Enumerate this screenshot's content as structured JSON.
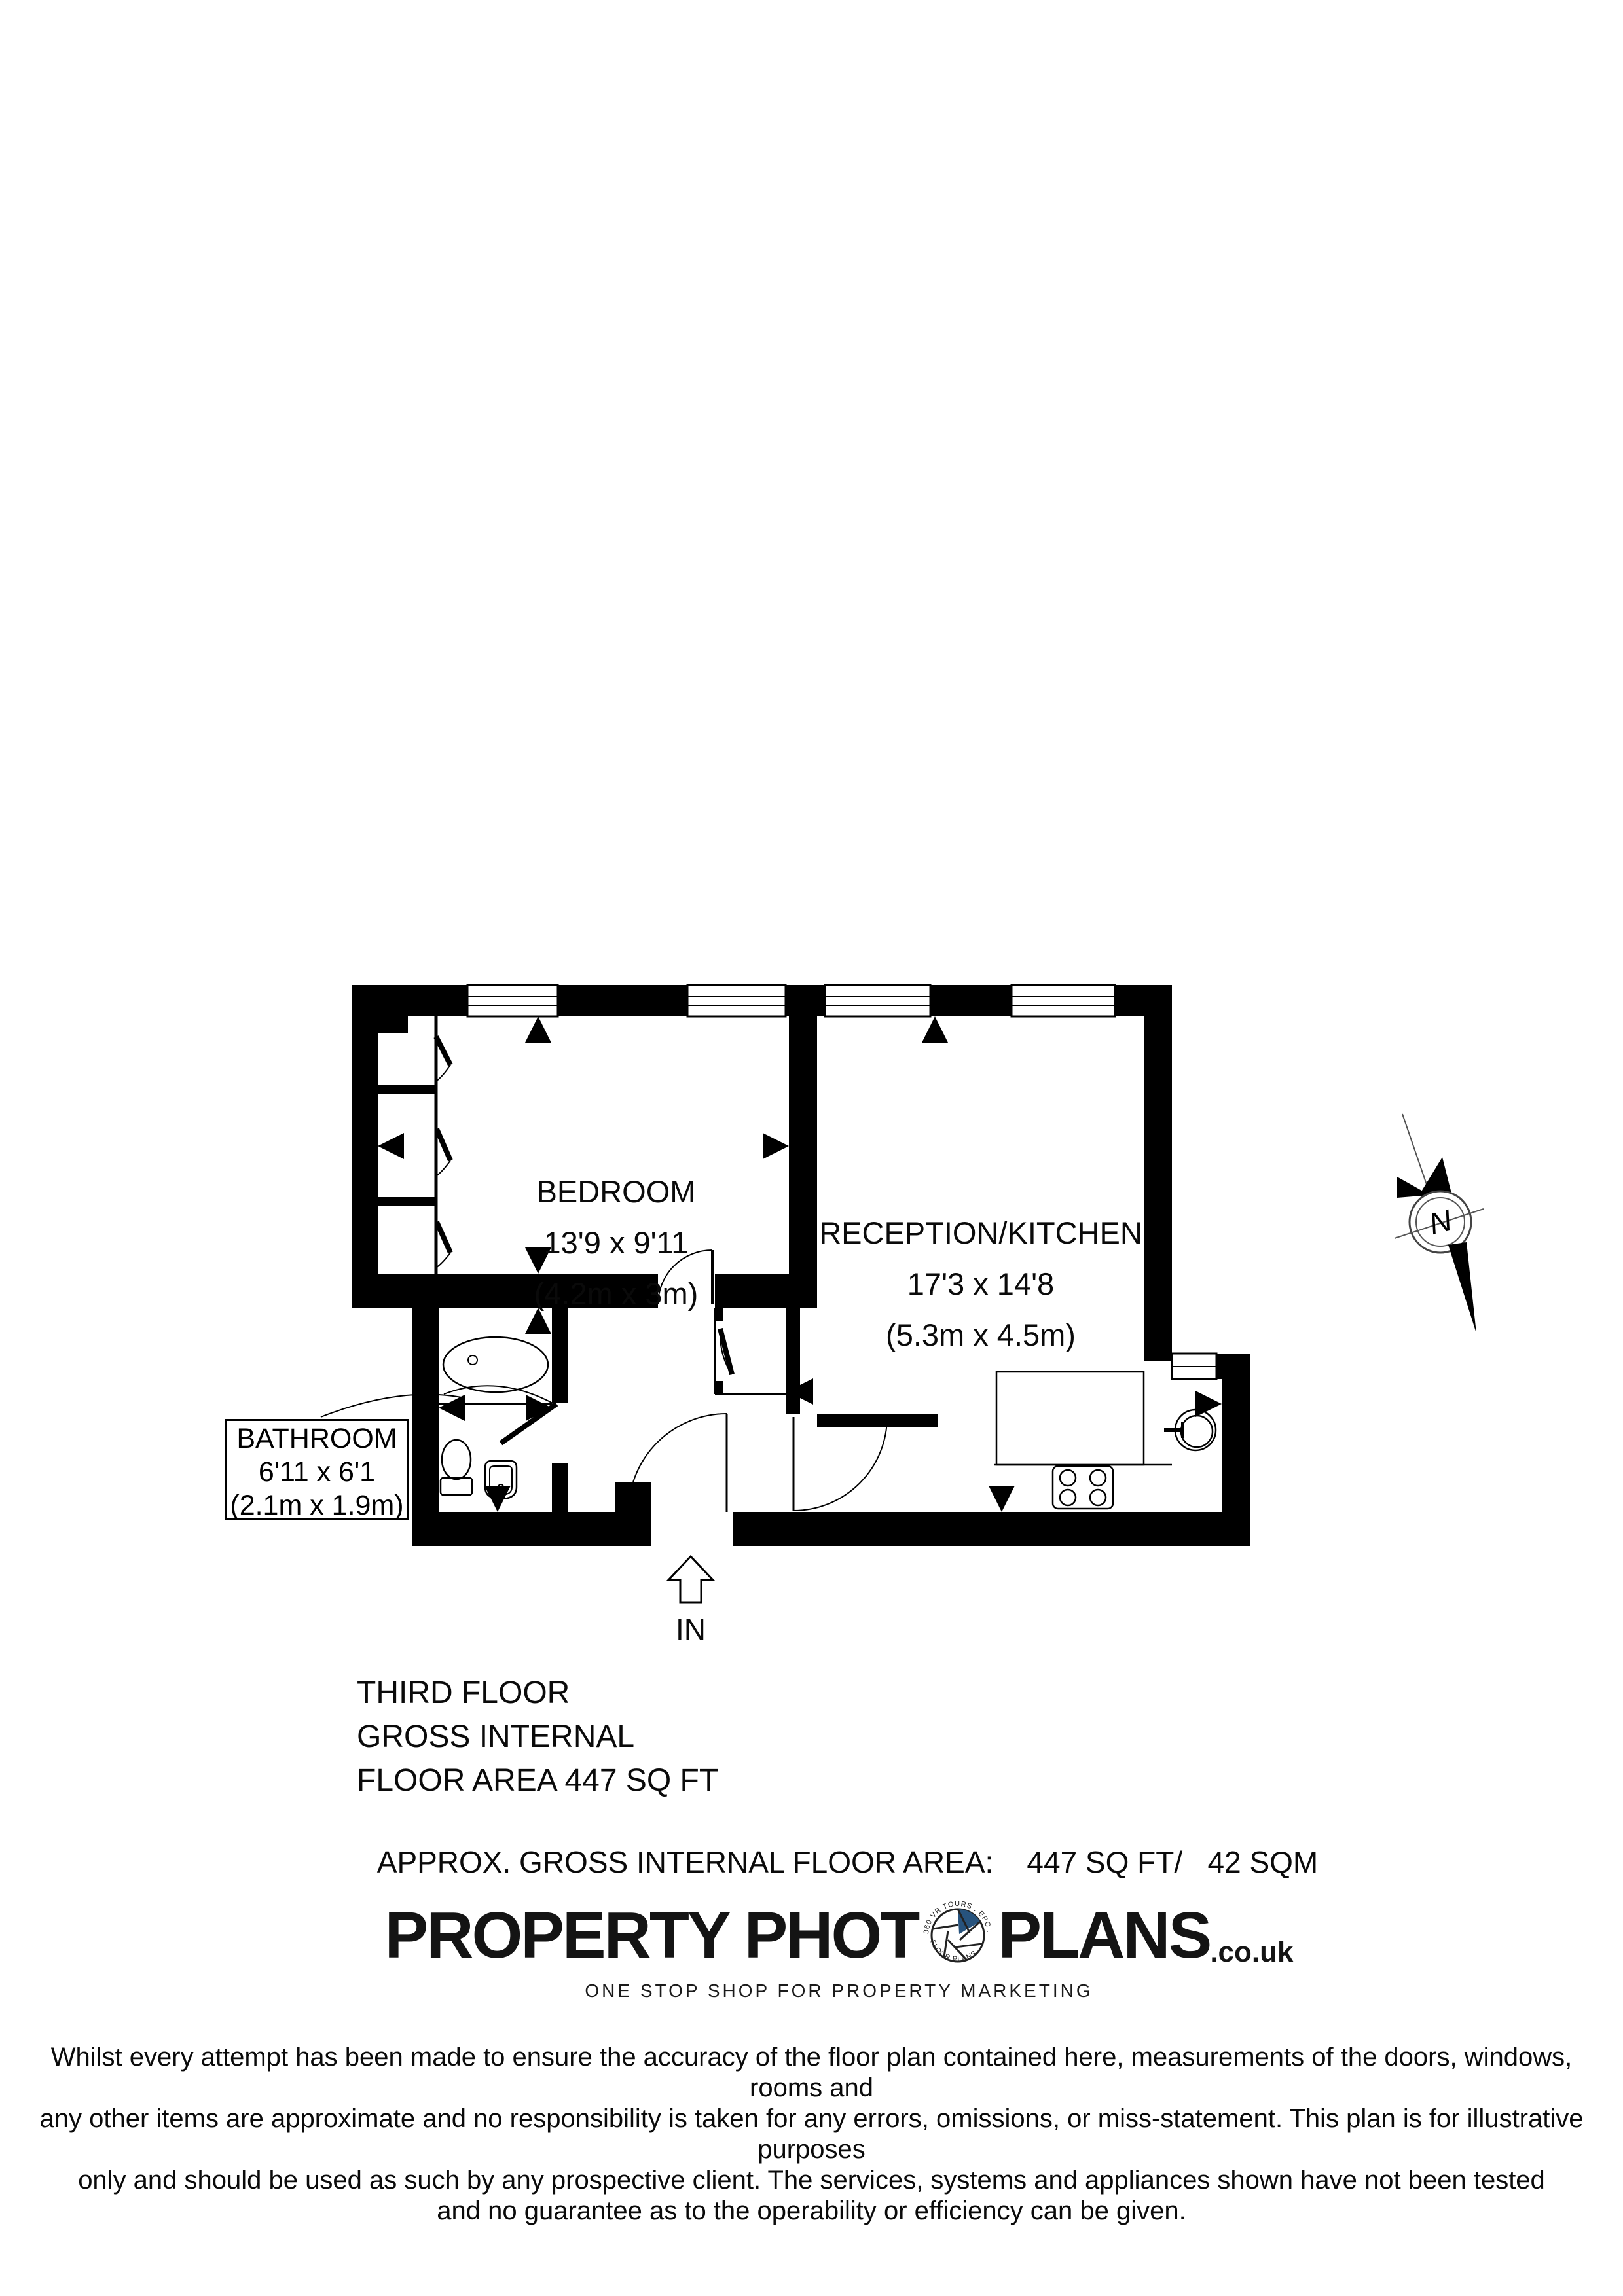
{
  "page": {
    "background": "#ffffff",
    "ink": "#000000"
  },
  "plan": {
    "rooms": [
      {
        "id": "bedroom",
        "name": "BEDROOM",
        "imperial": "13'9 x 9'11",
        "metric": "(4.2m x 3m)"
      },
      {
        "id": "reception",
        "name": "RECEPTION/KITCHEN",
        "imperial": "17'3 x 14'8",
        "metric": "(5.3m x 4.5m)"
      },
      {
        "id": "bathroom",
        "name": "BATHROOM",
        "imperial": "6'11 x 6'1",
        "metric": "(2.1m x 1.9m)"
      }
    ],
    "entrance_label": "IN",
    "compass_label": "N"
  },
  "summary": {
    "lines": [
      "THIRD FLOOR",
      "GROSS INTERNAL",
      "FLOOR AREA 447 SQ FT"
    ]
  },
  "area_line": "APPROX. GROSS INTERNAL FLOOR AREA:    447 SQ FT/   42 SQM",
  "logo": {
    "part1": "PROPERTY PHOT",
    "part2": "PLANS",
    "suffix": ".co.uk",
    "tagline": "ONE STOP SHOP FOR PROPERTY MARKETING",
    "ring_top": "360 VR TOURS . EPC . PHOTOGRAPHY .",
    "ring_bottom": "FLOOR PLANS .",
    "accent": "#27537d"
  },
  "disclaimer": {
    "lines": [
      "Whilst every attempt has been made to ensure the accuracy of the floor plan contained here, measurements of the doors, windows, rooms and",
      "any other items are approximate and no responsibility is taken for any errors, omissions, or miss-statement. This plan is for illustrative purposes",
      "only and should be used as such by any prospective client. The services, systems and appliances shown have not been tested",
      "and no guarantee as to the operability or efficiency can be given."
    ]
  }
}
